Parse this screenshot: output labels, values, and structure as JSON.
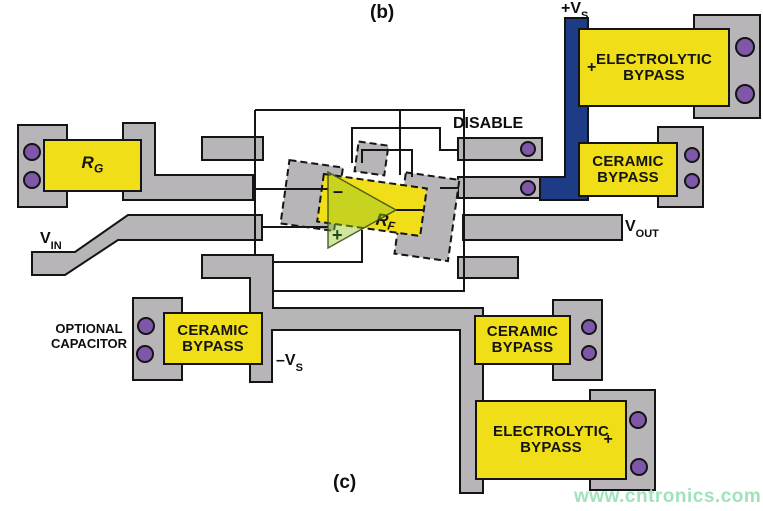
{
  "figure": {
    "panel_top": "(b)",
    "panel_bottom": "(c)"
  },
  "nets": {
    "vs_plus": {
      "base": "+V",
      "sub": "S"
    },
    "vs_minus": {
      "base": "–V",
      "sub": "S"
    },
    "vin": {
      "base": "V",
      "sub": "IN"
    },
    "vout": {
      "base": "V",
      "sub": "OUT"
    },
    "disable": "DISABLE"
  },
  "components": {
    "rg": {
      "base": "R",
      "sub": "G"
    },
    "rf": {
      "base": "R",
      "sub": "F"
    },
    "opamp": {
      "minus_input": "–",
      "plus_input": "+"
    },
    "top_electrolytic": {
      "line1": "ELECTROLYTIC",
      "line2": "BYPASS",
      "polarity": "+"
    },
    "top_ceramic": {
      "line1": "CERAMIC",
      "line2": "BYPASS"
    },
    "optional_ceramic": {
      "line1": "CERAMIC",
      "line2": "BYPASS"
    },
    "bottom_ceramic": {
      "line1": "CERAMIC",
      "line2": "BYPASS"
    },
    "bottom_electrolytic": {
      "line1": "ELECTROLYTIC",
      "line2": "BYPASS",
      "polarity": "+"
    },
    "optional_note": {
      "line1": "OPTIONAL",
      "line2": "CAPACITOR"
    }
  },
  "watermark": {
    "text": "www.cntronics.com",
    "color": "#96e0b2"
  },
  "colors": {
    "trace_gray": "#b7b5b8",
    "component_yellow": "#f0df18",
    "via_purple": "#7e57a8",
    "power_blue": "#1e3c86",
    "opamp_green": "#9cc42c",
    "outline_black": "#141414"
  }
}
